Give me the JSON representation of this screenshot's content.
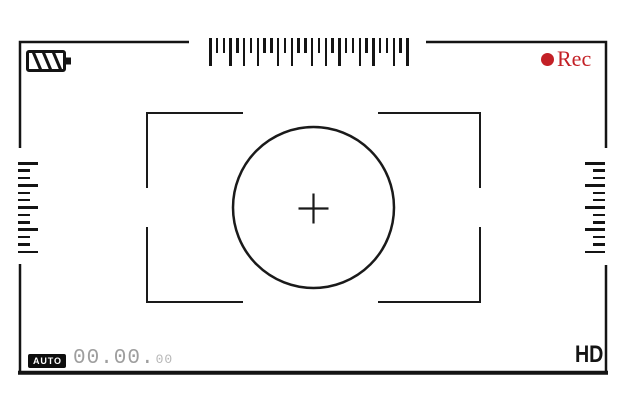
{
  "window": {
    "width": 626,
    "height": 418,
    "background": "#ffffff"
  },
  "status_bar": {
    "battery_icon": "battery-striped-icon",
    "rec_label": "Rec",
    "auto_label": "AUTO",
    "counter_main": "00.00.",
    "counter_frames": "00",
    "counter_full": "00.00.00",
    "hd_label": "HD"
  },
  "focus_area": {
    "shape": "circle-with-crosshair",
    "crosshair_icon": "plus-crosshair-icon",
    "bracket_corners": 4
  },
  "rulers": {
    "top": {
      "orientation": "horizontal",
      "pattern": [
        "L",
        "s",
        "s",
        "L",
        "s",
        "L",
        "s",
        "L",
        "s",
        "s",
        "L",
        "s",
        "L",
        "s",
        "s",
        "L",
        "s",
        "L",
        "s",
        "L",
        "s",
        "s",
        "L",
        "s",
        "L",
        "s",
        "s",
        "L",
        "s",
        "L"
      ]
    },
    "left": {
      "orientation": "vertical",
      "pattern": [
        "L",
        "s",
        "s",
        "L",
        "s",
        "s",
        "L",
        "s",
        "s",
        "L",
        "s",
        "s",
        "L"
      ]
    },
    "right": {
      "orientation": "vertical",
      "pattern": [
        "L",
        "s",
        "s",
        "L",
        "s",
        "s",
        "L",
        "s",
        "s",
        "L",
        "s",
        "s",
        "L"
      ]
    }
  },
  "colors": {
    "line": "#141414",
    "rec_red": "#c32026",
    "counter_gray": "#9e9e9e",
    "badge_bg": "#0d0d0d",
    "badge_text": "#ffffff"
  }
}
